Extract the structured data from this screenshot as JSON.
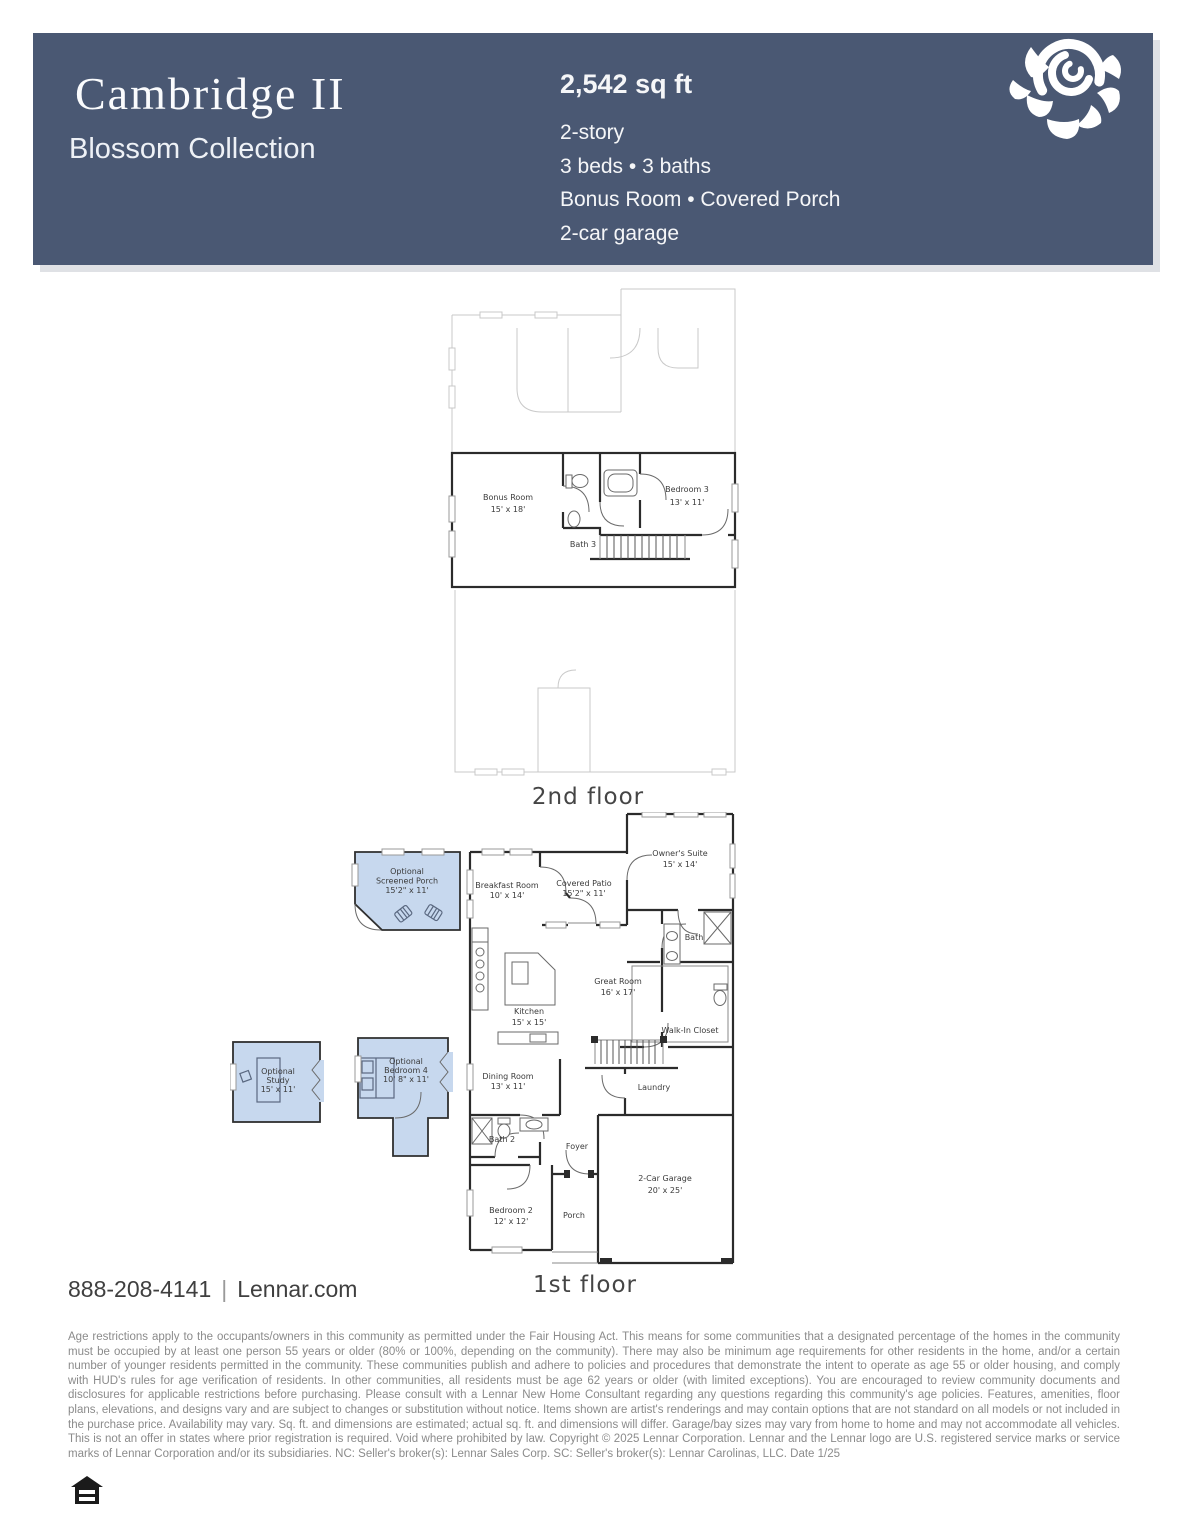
{
  "colors": {
    "header_bg": "#4a5873",
    "optional_room_fill": "#c7d8ee",
    "wall": "#2b2b2b",
    "ghost_outline": "#c9c9c9"
  },
  "header": {
    "title": "Cambridge II",
    "collection": "Blossom Collection",
    "sqft": "2,542 sq ft",
    "spec_lines": [
      "2-story",
      "3 beds • 3 baths",
      "Bonus Room • Covered Porch",
      "2-car garage"
    ]
  },
  "floor2": {
    "caption": "2nd floor",
    "rooms": {
      "bonus": {
        "lines": [
          "Bonus Room",
          "15' x 18'"
        ]
      },
      "bath3": {
        "lines": [
          "Bath 3"
        ]
      },
      "bedroom3": {
        "lines": [
          "Bedroom 3",
          "13' x 11'"
        ]
      }
    }
  },
  "floor1": {
    "caption": "1st floor",
    "rooms": {
      "screened_porch": {
        "lines": [
          "Optional",
          "Screened Porch",
          "15'2\" x 11'"
        ]
      },
      "breakfast": {
        "lines": [
          "Breakfast Room",
          "10' x 14'"
        ]
      },
      "covered_patio": {
        "lines": [
          "Covered Patio",
          "15'2\" x 11'"
        ]
      },
      "owners_suite": {
        "lines": [
          "Owner's Suite",
          "15' x 14'"
        ]
      },
      "bath": {
        "lines": [
          "Bath"
        ]
      },
      "great_room": {
        "lines": [
          "Great Room",
          "16' x 17'"
        ]
      },
      "kitchen": {
        "lines": [
          "Kitchen",
          "15' x 15'"
        ]
      },
      "walk_in_closet": {
        "lines": [
          "Walk-In Closet"
        ]
      },
      "study": {
        "lines": [
          "Optional",
          "Study",
          "15' x 11'"
        ]
      },
      "bedroom4": {
        "lines": [
          "Optional",
          "Bedroom 4",
          "10' 8\" x 11'"
        ]
      },
      "dining": {
        "lines": [
          "Dining Room",
          "13' x 11'"
        ]
      },
      "laundry": {
        "lines": [
          "Laundry"
        ]
      },
      "bath2": {
        "lines": [
          "Bath 2"
        ]
      },
      "foyer": {
        "lines": [
          "Foyer"
        ]
      },
      "bedroom2": {
        "lines": [
          "Bedroom 2",
          "12' x 12'"
        ]
      },
      "porch": {
        "lines": [
          "Porch"
        ]
      },
      "garage": {
        "lines": [
          "2-Car Garage",
          "20' x 25'"
        ]
      }
    }
  },
  "footer": {
    "phone": "888-208-4141",
    "divider": "|",
    "website": "Lennar.com",
    "disclaimer": "Age restrictions apply to the occupants/owners in this community as permitted under the Fair Housing Act. This means for some communities that a designated percentage of the homes in the community must be occupied by at least one person 55 years or older (80% or 100%, depending on the community). There may also be minimum age requirements for other residents in the home, and/or a certain number of younger residents permitted in the community. These communities publish and adhere to policies and procedures that demonstrate the intent to operate as age 55 or older housing, and comply with HUD's rules for age verification of residents. In other communities, all residents must be age 62 years or older (with limited exceptions). You are encouraged to review community documents and disclosures for applicable restrictions before purchasing. Please consult with a Lennar New Home Consultant regarding any questions regarding this community's age policies. Features, amenities, floor plans, elevations, and designs vary and are subject to changes or substitution without notice. Items shown are artist's renderings and may contain options that are not standard on all models or not included in the purchase price. Availability may vary. Sq. ft. and dimensions are estimated; actual sq. ft. and dimensions will differ. Garage/bay sizes may vary from home to home and may not accommodate all vehicles. This is not an offer in states where prior registration is required. Void where prohibited by law. Copyright © 2025 Lennar Corporation. Lennar and the Lennar logo are U.S. registered service marks or service marks of Lennar Corporation and/or its subsidiaries. NC: Seller's broker(s): Lennar Sales Corp. SC: Seller's broker(s): Lennar Carolinas, LLC. Date 1/25"
  }
}
